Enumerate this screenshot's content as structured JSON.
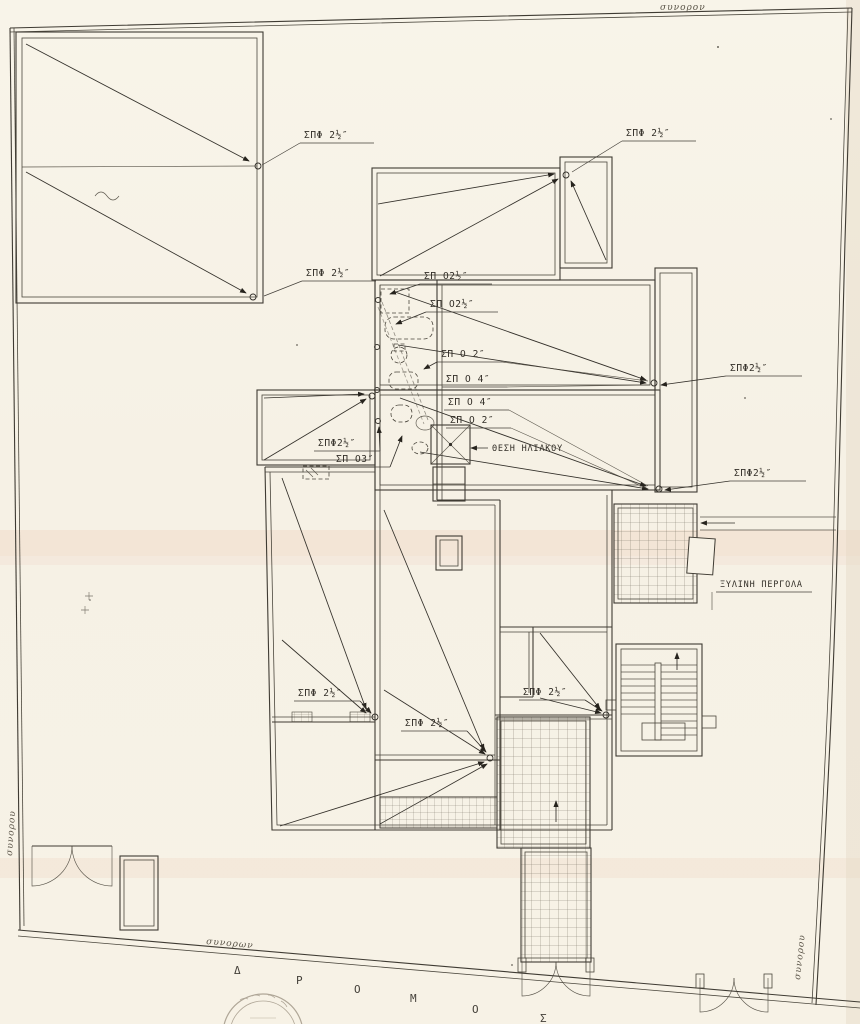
{
  "drawing": {
    "kind": "scanned architectural site / roof drainage plan",
    "language": "Greek"
  },
  "colors": {
    "paper": "#f7f2e6",
    "ink": "#3f3b33",
    "scan_band_pink": "#e9b9a4"
  },
  "boundary": {
    "top": "συνορον",
    "left": "συνορου",
    "bottom": "συνορων",
    "right": "συνορου"
  },
  "road": {
    "name": "ΔΡΟΜΟΣ",
    "letters": [
      "Δ",
      "Ρ",
      "Ο",
      "Μ",
      "Ο",
      "Σ"
    ]
  },
  "pipe_labels": [
    {
      "t": "ΣΠΦ 2½″"
    },
    {
      "t": "ΣΠΦ 2½″"
    },
    {
      "t": "ΣΠΦ 2½″"
    },
    {
      "t": "ΣΠ Ο2½″"
    },
    {
      "t": "ΣΠ Ο2½″"
    },
    {
      "t": "ΣΠ Ο 2″"
    },
    {
      "t": "ΣΠ Ο 4″"
    },
    {
      "t": "ΣΠ Ο 4″"
    },
    {
      "t": "ΣΠ Ο 2″"
    },
    {
      "t": "ΣΠΦ2½″"
    },
    {
      "t": "ΣΠ Ο3″"
    },
    {
      "t": "ΣΠΦ2½″"
    },
    {
      "t": "ΣΠΦ2½″"
    },
    {
      "t": "ΣΠΦ 2½″"
    },
    {
      "t": "ΣΠΦ 2½″"
    },
    {
      "t": "ΣΠΦ 2½″"
    }
  ],
  "annotations": {
    "solar_heater": "ΘΕΣΗ ΗΛΙΑΚΟΥ",
    "pergola": "ΞΥΛΙΝΗ ΠΕΡΓΟΛΑ"
  }
}
